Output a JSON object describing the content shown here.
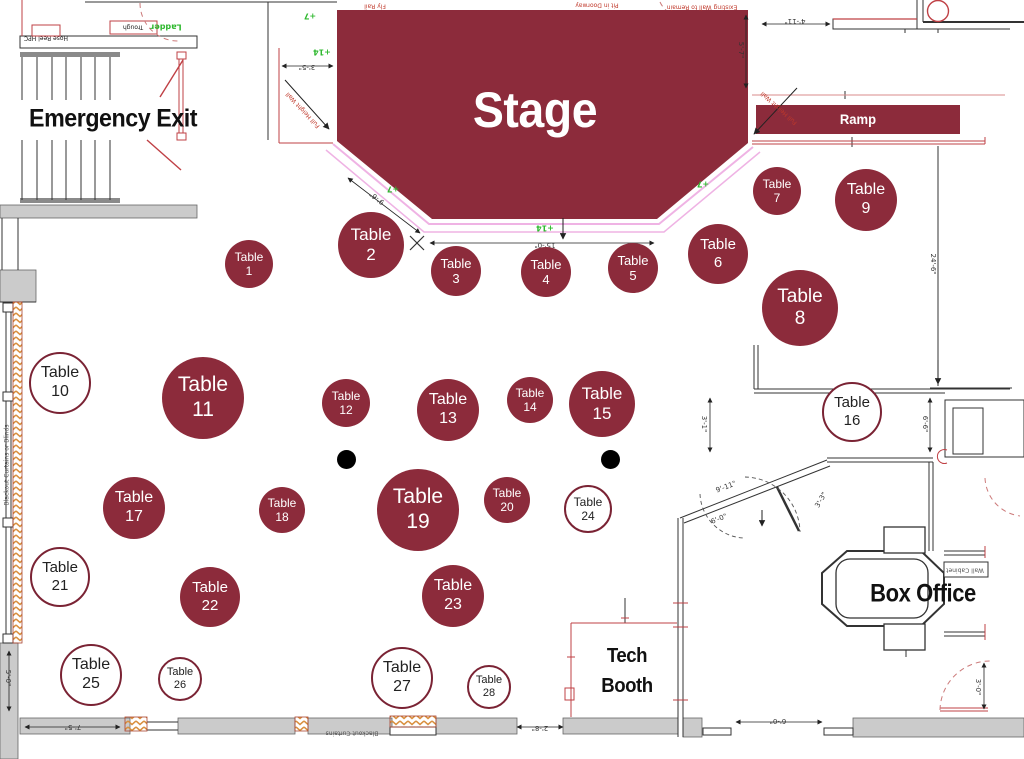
{
  "meta": {
    "width": 1024,
    "height": 759,
    "title": "Venue seating floor plan"
  },
  "colors": {
    "maroon": "#8C2B3B",
    "maroon_border": "#7A2334",
    "stage_edge_pink": "#EFB3E4",
    "elevation_green": "#2eb82e",
    "arch_red": "#BF4045",
    "wall_gray": "#CBCBCB",
    "hatch_orange": "#D98F3E",
    "text_dark": "#111111"
  },
  "areas": {
    "stage": "Stage",
    "ramp": "Ramp",
    "emergency_exit": "Emergency Exit",
    "box_office": "Box Office",
    "tech_booth": {
      "line1": "Tech",
      "line2": "Booth"
    }
  },
  "tables": {
    "word": "Table",
    "items": [
      {
        "n": 1,
        "x": 249,
        "y": 264,
        "r": 24,
        "filled": true
      },
      {
        "n": 2,
        "x": 371,
        "y": 245,
        "r": 33,
        "filled": true
      },
      {
        "n": 3,
        "x": 456,
        "y": 271,
        "r": 25,
        "filled": true
      },
      {
        "n": 4,
        "x": 546,
        "y": 272,
        "r": 25,
        "filled": true
      },
      {
        "n": 5,
        "x": 633,
        "y": 268,
        "r": 25,
        "filled": true
      },
      {
        "n": 6,
        "x": 718,
        "y": 254,
        "r": 30,
        "filled": true
      },
      {
        "n": 7,
        "x": 777,
        "y": 191,
        "r": 24,
        "filled": true
      },
      {
        "n": 8,
        "x": 800,
        "y": 308,
        "r": 38,
        "filled": true
      },
      {
        "n": 9,
        "x": 866,
        "y": 200,
        "r": 31,
        "filled": true
      },
      {
        "n": 10,
        "x": 60,
        "y": 383,
        "r": 31,
        "filled": false
      },
      {
        "n": 11,
        "x": 203,
        "y": 398,
        "r": 41,
        "filled": true
      },
      {
        "n": 12,
        "x": 346,
        "y": 403,
        "r": 24,
        "filled": true
      },
      {
        "n": 13,
        "x": 448,
        "y": 410,
        "r": 31,
        "filled": true
      },
      {
        "n": 14,
        "x": 530,
        "y": 400,
        "r": 23,
        "filled": true
      },
      {
        "n": 15,
        "x": 602,
        "y": 404,
        "r": 33,
        "filled": true
      },
      {
        "n": 16,
        "x": 852,
        "y": 412,
        "r": 30,
        "filled": false
      },
      {
        "n": 17,
        "x": 134,
        "y": 508,
        "r": 31,
        "filled": true
      },
      {
        "n": 18,
        "x": 282,
        "y": 510,
        "r": 23,
        "filled": true
      },
      {
        "n": 19,
        "x": 418,
        "y": 510,
        "r": 41,
        "filled": true
      },
      {
        "n": 20,
        "x": 507,
        "y": 500,
        "r": 23,
        "filled": true
      },
      {
        "n": 21,
        "x": 60,
        "y": 577,
        "r": 30,
        "filled": false
      },
      {
        "n": 22,
        "x": 210,
        "y": 597,
        "r": 30,
        "filled": true
      },
      {
        "n": 23,
        "x": 453,
        "y": 596,
        "r": 31,
        "filled": true
      },
      {
        "n": 24,
        "x": 588,
        "y": 509,
        "r": 24,
        "filled": false
      },
      {
        "n": 25,
        "x": 91,
        "y": 675,
        "r": 31,
        "filled": false
      },
      {
        "n": 26,
        "x": 180,
        "y": 679,
        "r": 22,
        "filled": false
      },
      {
        "n": 27,
        "x": 402,
        "y": 678,
        "r": 31,
        "filled": false
      },
      {
        "n": 28,
        "x": 489,
        "y": 687,
        "r": 22,
        "filled": false
      }
    ]
  },
  "dots": [
    {
      "x": 346,
      "y": 459,
      "r": 9.5
    },
    {
      "x": 610,
      "y": 459,
      "r": 9.5
    }
  ],
  "annotations": [
    {
      "t": "+7",
      "x": 310,
      "y": 16,
      "rot": 180,
      "c": "g"
    },
    {
      "t": "+14",
      "x": 322,
      "y": 52,
      "rot": 180,
      "c": "g"
    },
    {
      "t": "+7",
      "x": 393,
      "y": 189,
      "rot": 180,
      "c": "g"
    },
    {
      "t": "+7",
      "x": 703,
      "y": 184,
      "rot": 180,
      "c": "g"
    },
    {
      "t": "+14",
      "x": 545,
      "y": 228,
      "rot": 180,
      "c": "g"
    },
    {
      "t": "Ladder",
      "x": 166,
      "y": 27,
      "rot": 180,
      "c": "g"
    },
    {
      "t": "15'-0\"",
      "x": 545,
      "y": 245,
      "rot": 180,
      "c": "d"
    },
    {
      "t": "9'-6\"",
      "x": 377,
      "y": 198,
      "rot": 218,
      "c": "d"
    },
    {
      "t": "3'-5\"",
      "x": 307,
      "y": 67,
      "rot": 180,
      "c": "d"
    },
    {
      "t": "5'-7\"",
      "x": 741,
      "y": 50,
      "rot": 90,
      "c": "d"
    },
    {
      "t": "4'-11\"",
      "x": 795,
      "y": 21,
      "rot": 180,
      "c": "d"
    },
    {
      "t": "24'-6\"",
      "x": 933,
      "y": 264,
      "rot": 90,
      "c": "d"
    },
    {
      "t": "6'-6\"",
      "x": 925,
      "y": 424,
      "rot": 90,
      "c": "d"
    },
    {
      "t": "3'-1\"",
      "x": 704,
      "y": 424,
      "rot": 90,
      "c": "d"
    },
    {
      "t": "9'-11\"",
      "x": 726,
      "y": 487,
      "rot": -21,
      "c": "d"
    },
    {
      "t": "6'-0\"",
      "x": 719,
      "y": 519,
      "rot": -21,
      "c": "d"
    },
    {
      "t": "3'-3\"",
      "x": 821,
      "y": 500,
      "rot": -60,
      "c": "d"
    },
    {
      "t": "7'-5\"",
      "x": 73,
      "y": 727,
      "rot": 180,
      "c": "d"
    },
    {
      "t": "5'-0\"",
      "x": 8,
      "y": 678,
      "rot": 90,
      "c": "d"
    },
    {
      "t": "2'-8\"",
      "x": 540,
      "y": 728,
      "rot": 180,
      "c": "d"
    },
    {
      "t": "6'-0\"",
      "x": 778,
      "y": 721,
      "rot": 180,
      "c": "d"
    },
    {
      "t": "3'-0\"",
      "x": 978,
      "y": 687,
      "rot": 90,
      "c": "d"
    },
    {
      "t": "Fly Rail",
      "x": 375,
      "y": 6,
      "rot": 180,
      "c": "r"
    },
    {
      "t": "Pit in Doorway",
      "x": 597,
      "y": 5,
      "rot": 180,
      "c": "r"
    },
    {
      "t": "Existing Wall to Remain",
      "x": 702,
      "y": 7,
      "rot": 180,
      "c": "r"
    },
    {
      "t": "Full Height Wall",
      "x": 303,
      "y": 110,
      "rot": 227,
      "c": "r"
    },
    {
      "t": "Full Height Wall",
      "x": 779,
      "y": 108,
      "rot": 222,
      "c": "r"
    },
    {
      "t": "Trough",
      "x": 133,
      "y": 27,
      "rot": 180,
      "c": "b"
    },
    {
      "t": "Hose Reel HPC",
      "x": 46,
      "y": 38,
      "rot": 180,
      "c": "b"
    },
    {
      "t": "Blackout Curtains or Blinds",
      "x": 7,
      "y": 465,
      "rot": -90,
      "c": "n"
    },
    {
      "t": "Blackout Curtains",
      "x": 352,
      "y": 733,
      "rot": 180,
      "c": "n"
    },
    {
      "t": "Wall Cabinet",
      "x": 965,
      "y": 570,
      "rot": 180,
      "c": "n"
    }
  ]
}
